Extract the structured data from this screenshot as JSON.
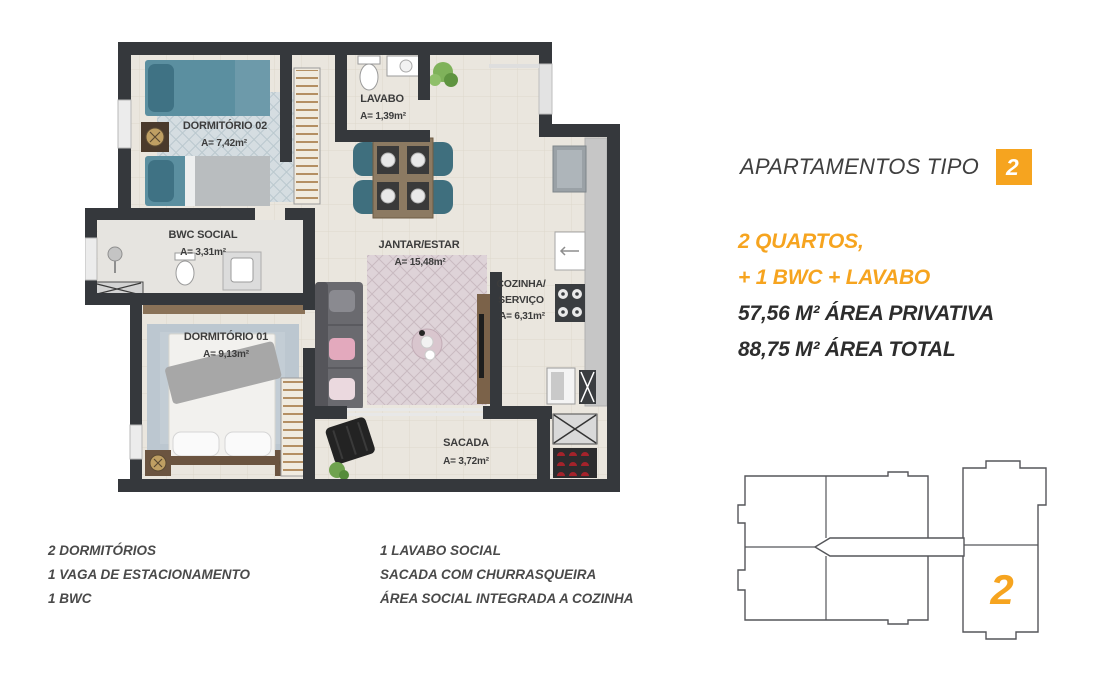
{
  "colors": {
    "accent_orange": "#F6A41F",
    "wall_dark": "#35383C",
    "floor_beige": "#EAE6DE",
    "teal_furniture": "#5B8FA0",
    "text_dark": "#2D2D2D",
    "text_features": "#4A4A4A"
  },
  "header": {
    "title": "APARTAMENTOS TIPO",
    "unit_number": "2"
  },
  "specs": [
    {
      "text": "2 QUARTOS,",
      "style": "orange"
    },
    {
      "text": "+ 1 BWC + LAVABO",
      "style": "orange"
    },
    {
      "text": "57,56 M² ÁREA PRIVATIVA",
      "style": "dark"
    },
    {
      "text": "88,75 M² ÁREA TOTAL",
      "style": "dark"
    }
  ],
  "features_left": [
    "2 DORMITÓRIOS",
    "1 VAGA DE ESTACIONAMENTO",
    "1 BWC"
  ],
  "features_right": [
    "1 LAVABO SOCIAL",
    "SACADA COM CHURRASQUEIRA",
    "ÁREA SOCIAL INTEGRADA A COZINHA"
  ],
  "floorplan": {
    "rooms": {
      "dorm02": {
        "name": "DORMITÓRIO 02",
        "area": "A= 7,42m²"
      },
      "lavabo": {
        "name": "LAVABO",
        "area": "A= 1,39m²"
      },
      "bwc": {
        "name": "BWC SOCIAL",
        "area": "A= 3,31m²"
      },
      "dorm01": {
        "name": "DORMITÓRIO 01",
        "area": "A= 9,13m²"
      },
      "jantar": {
        "name": "JANTAR/ESTAR",
        "area": "A= 15,48m²"
      },
      "cozinha": {
        "line1": "COZINHA/",
        "line2": "SERVIÇO",
        "area": "A= 6,31m²"
      },
      "sacada": {
        "name": "SACADA",
        "area": "A= 3,72m²"
      }
    }
  },
  "keyplan": {
    "unit_label": "2"
  }
}
